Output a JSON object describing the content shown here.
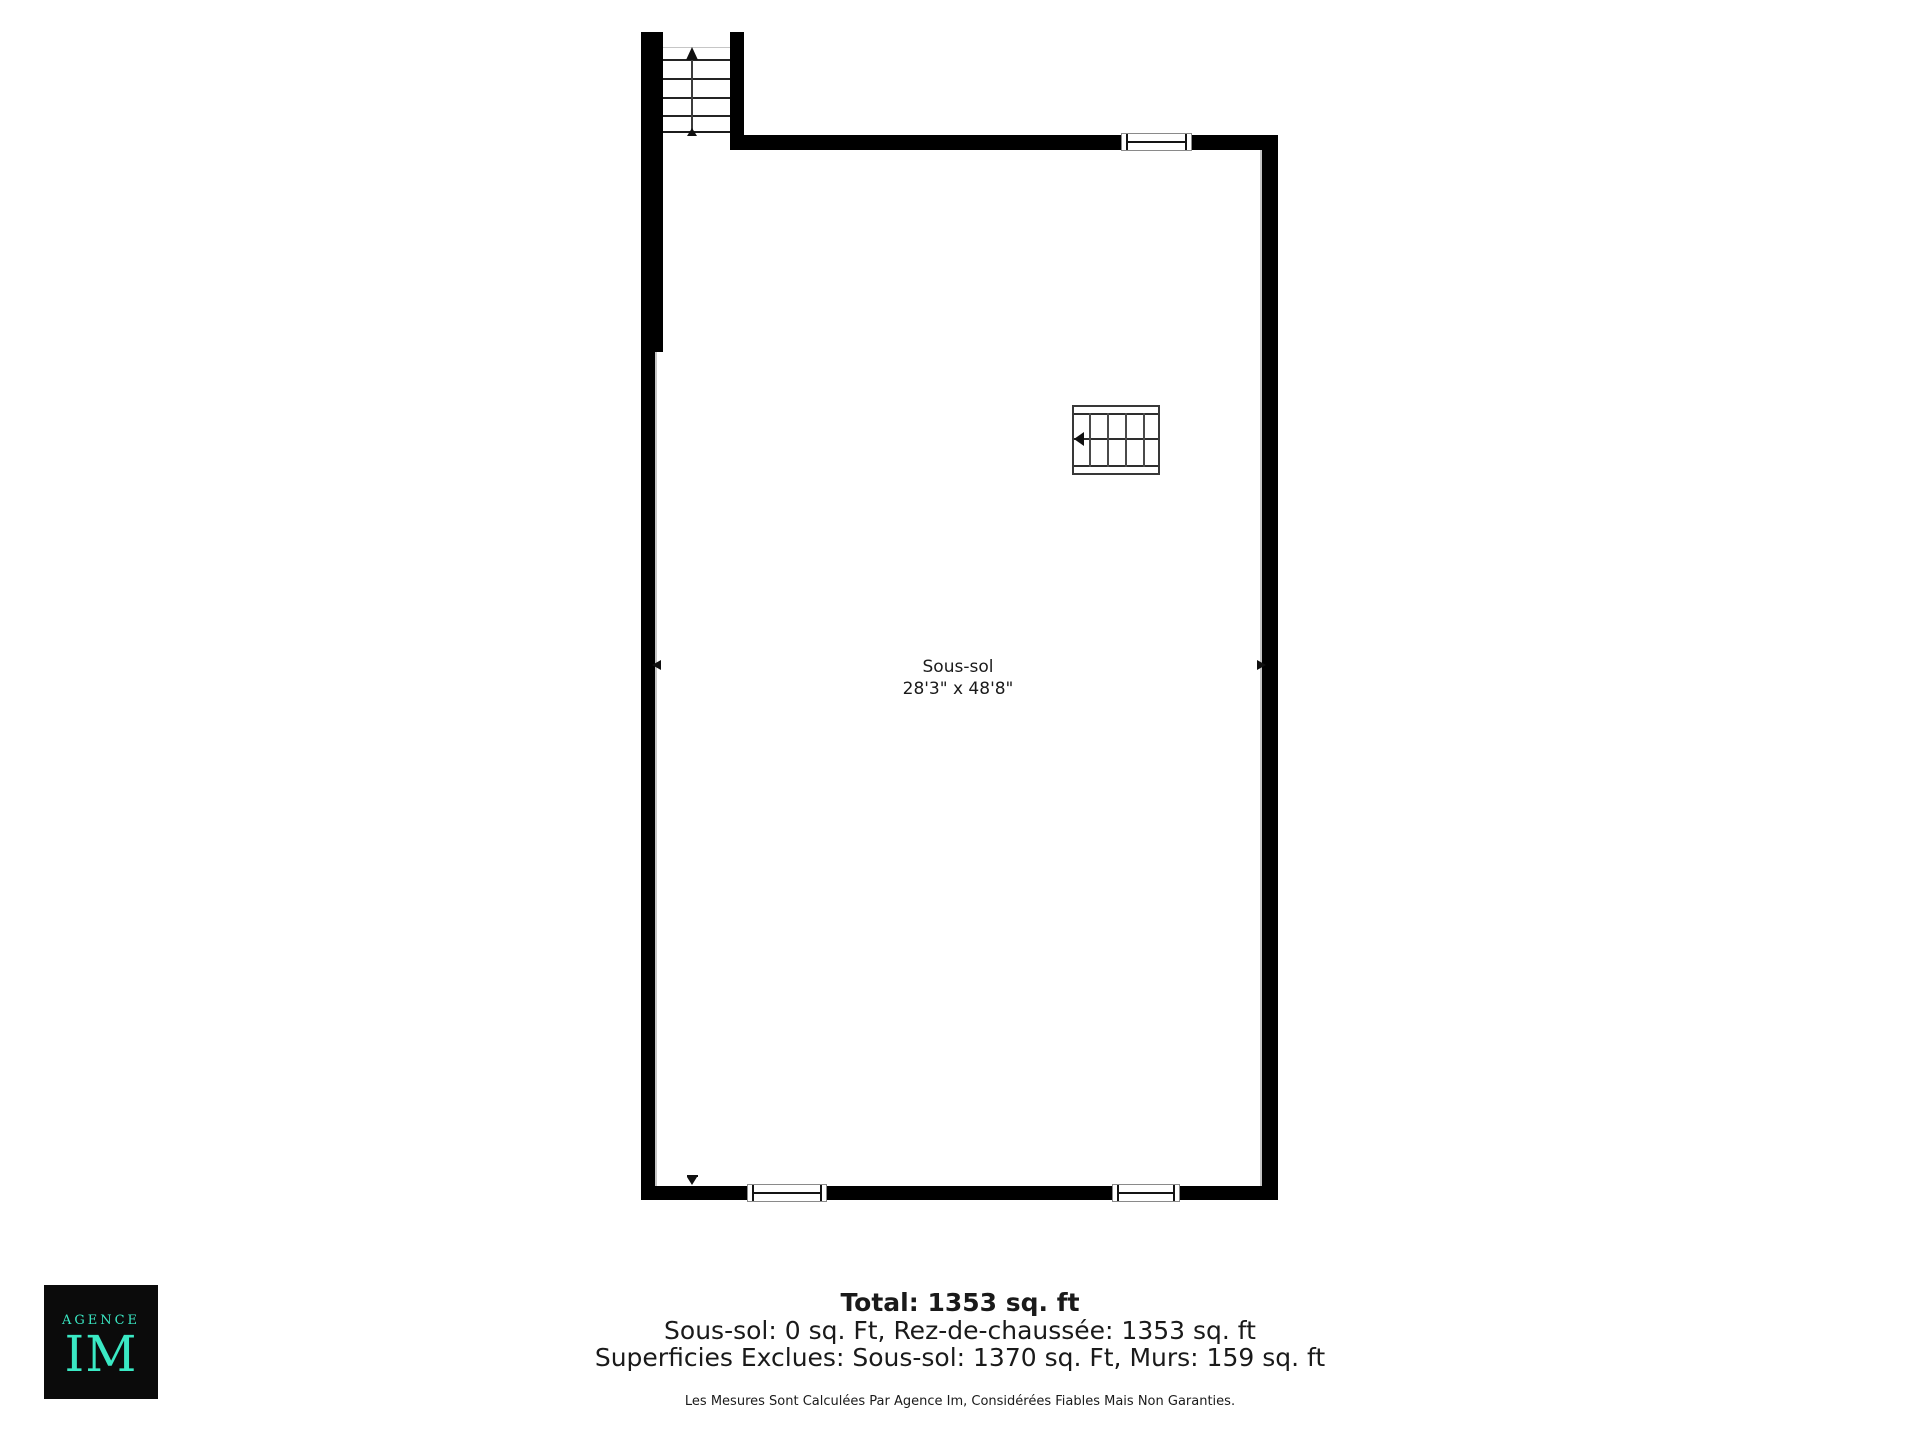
{
  "room": {
    "name": "Sous-sol",
    "dimensions": "28'3\" x 48'8\""
  },
  "summary": {
    "total": "Total: 1353 sq. ft",
    "breakdown": "Sous-sol: 0 sq. Ft, Rez-de-chaussée: 1353 sq. ft",
    "exclusions": "Superficies Exclues: Sous-sol: 1370 sq. Ft, Murs: 159 sq. ft"
  },
  "disclaimer": "Les Mesures Sont Calculées Par Agence Im, Considérées Fiables Mais Non Garanties.",
  "logo": {
    "line1": "AGENCE",
    "line2": "IM"
  },
  "icons": {
    "stair_up_arrow": "▲",
    "stair_left_arrow": "◀",
    "dimension_marker_left": "◀",
    "dimension_marker_right": "▶",
    "dimension_marker_down": "▼"
  },
  "colors": {
    "wall": "#000000",
    "accent_gray": "#c6c6c6",
    "text": "#1a1a1a",
    "logo_bg": "#0b0b0b",
    "logo_text": "#3ae9c4"
  }
}
